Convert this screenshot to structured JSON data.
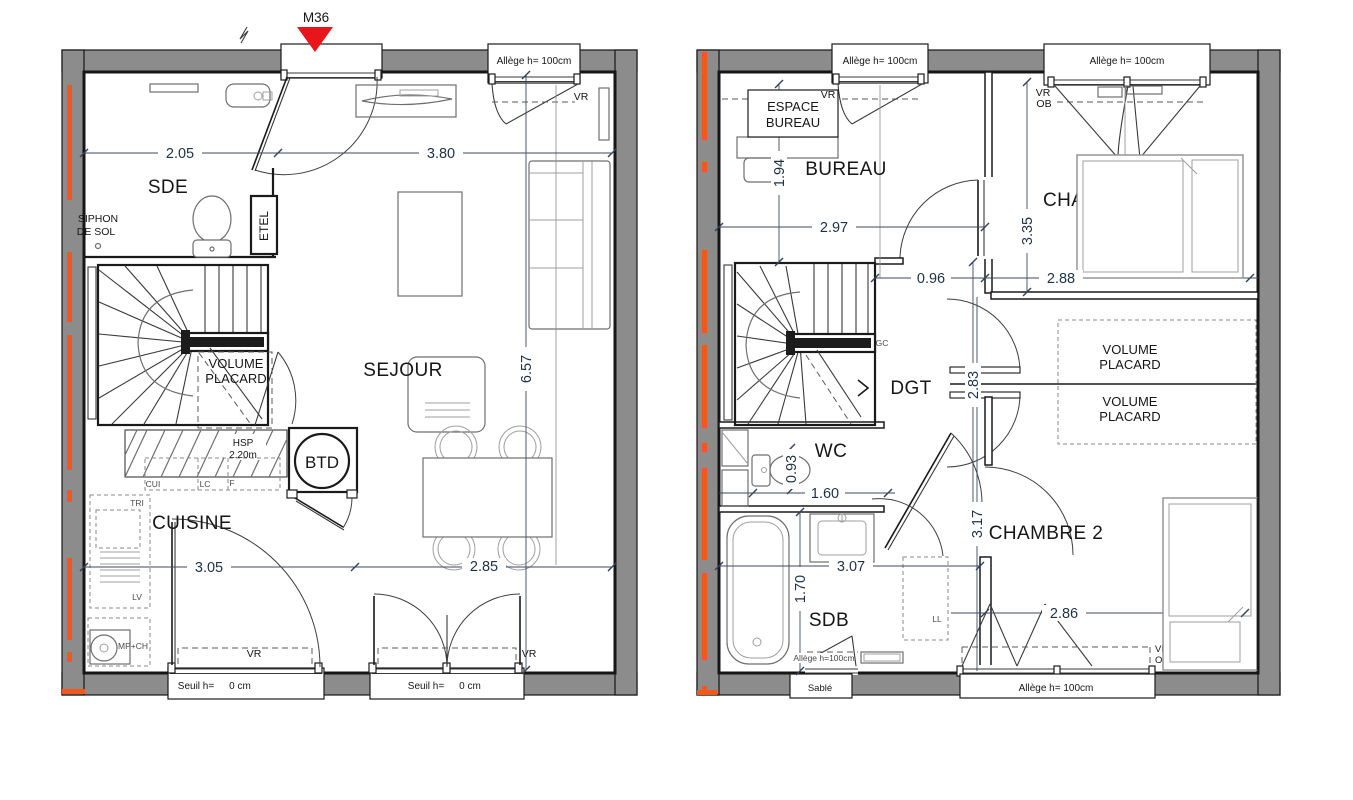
{
  "marker": {
    "label": "M36"
  },
  "p1": {
    "win_top": {
      "allege": "Allège h= 100cm",
      "vr": "VR"
    },
    "dims": {
      "a": "2.05",
      "b": "3.80",
      "v": "6.57",
      "c": "3.05",
      "d": "2.85"
    },
    "sde": "SDE",
    "siphon1": "SIPHON",
    "siphon2": "DE SOL",
    "etel": "ETEL",
    "vol1": "VOLUME",
    "vol2": "PLACARD",
    "sejour": "SEJOUR",
    "hsp1": "HSP",
    "hsp2": "2.20m",
    "btd": "BTD",
    "cui": "CUI",
    "lc": "LC",
    "f": "F",
    "tri": "TRI",
    "lv": "LV",
    "mpch": "MP+CH",
    "cuisine": "CUISINE",
    "win_bl": {
      "vr": "VR",
      "seuil": "Seuil h=",
      "val": "0 cm"
    },
    "win_br": {
      "vr": "VR",
      "seuil": "Seuil h=",
      "val": "0 cm"
    }
  },
  "p2": {
    "win_tl": {
      "allege": "Allège h= 100cm",
      "vr": "VR"
    },
    "win_tr": {
      "allege": "Allège h=  100cm",
      "vr": "VR",
      "ob": "OB"
    },
    "espace1": "ESPACE",
    "espace2": "BUREAU",
    "bureau": "BUREAU",
    "chambre1": "CHAMBRE 1",
    "dims": {
      "v194": "1.94",
      "h297": "2.97",
      "v335": "3.35",
      "h096": "0.96",
      "h288": "2.88",
      "v283": "2.83",
      "v093": "0.93",
      "h160": "1.60",
      "h307": "3.07",
      "v170": "1.70",
      "v317": "3.17",
      "h286": "2.86"
    },
    "gc": "GC",
    "dgt": "DGT",
    "volA1": "VOLUME",
    "volA2": "PLACARD",
    "volB1": "VOLUME",
    "volB2": "PLACARD",
    "wc": "WC",
    "sdb": "SDB",
    "chambre2": "CHAMBRE 2",
    "ll": "LL",
    "win_bl": {
      "allege": "Allège h=100cm",
      "sable": "Sablé"
    },
    "win_br": {
      "allege": "Allège h= 100cm",
      "vr": "VR",
      "ob": "OB"
    }
  },
  "colors": {
    "wall": "#8c8c8c",
    "orange": "#f2571d",
    "red": "#e8151b",
    "dim_text": "#1d3147",
    "line": "#1a1a1a"
  }
}
